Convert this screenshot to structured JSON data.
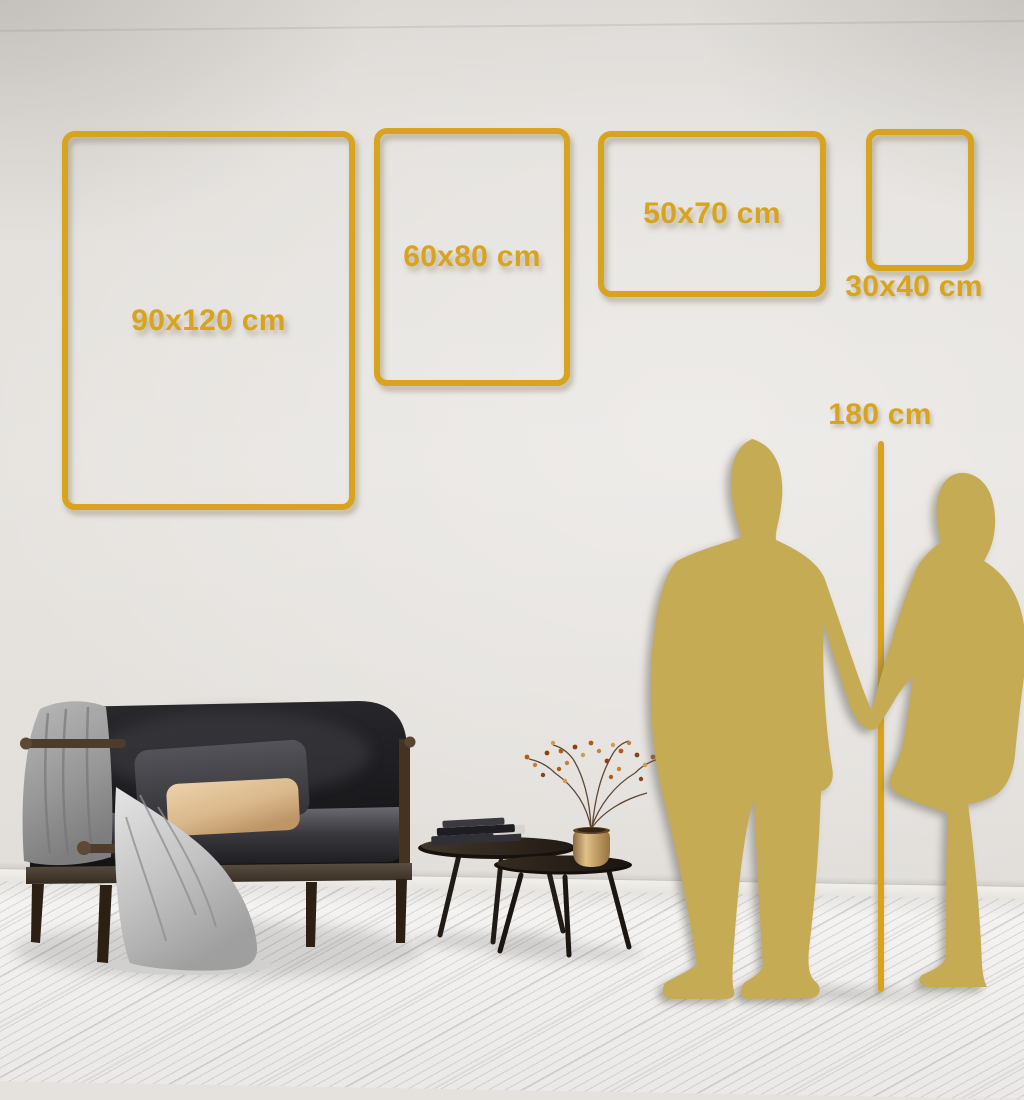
{
  "scene": {
    "description": "Poster size guide wall mockup: gold frame outlines on a wall, a gold couple silhouette with a 180 cm height line, dark sofa with blanket and pillows, two nesting coffee tables with books and a gold vase holding a dried berry branch, whitewashed wood floor"
  },
  "size_guide": {
    "frames": [
      {
        "label": "90x120 cm"
      },
      {
        "label": "60x80 cm"
      },
      {
        "label": "50x70 cm"
      },
      {
        "label": "30x40 cm"
      }
    ],
    "height_marker": {
      "label": "180 cm"
    }
  },
  "colors": {
    "accent": "#D8A41F",
    "silhouette": "#C6AB55",
    "wall": "#E5E2DE",
    "floor": "#F3F2F0",
    "baseboard": "#EFEDE9",
    "sofa": "#1C1B1E",
    "pillow_dark": "#48474C",
    "pillow_beige": "#DCBA8E",
    "blanket": "#939393",
    "throw": "#C6C6C6",
    "wood": "#4D3B2B",
    "table": "#2A231C",
    "vase": "#D8B87E",
    "branch": "#5F4733",
    "berry": "#B05A1E"
  }
}
